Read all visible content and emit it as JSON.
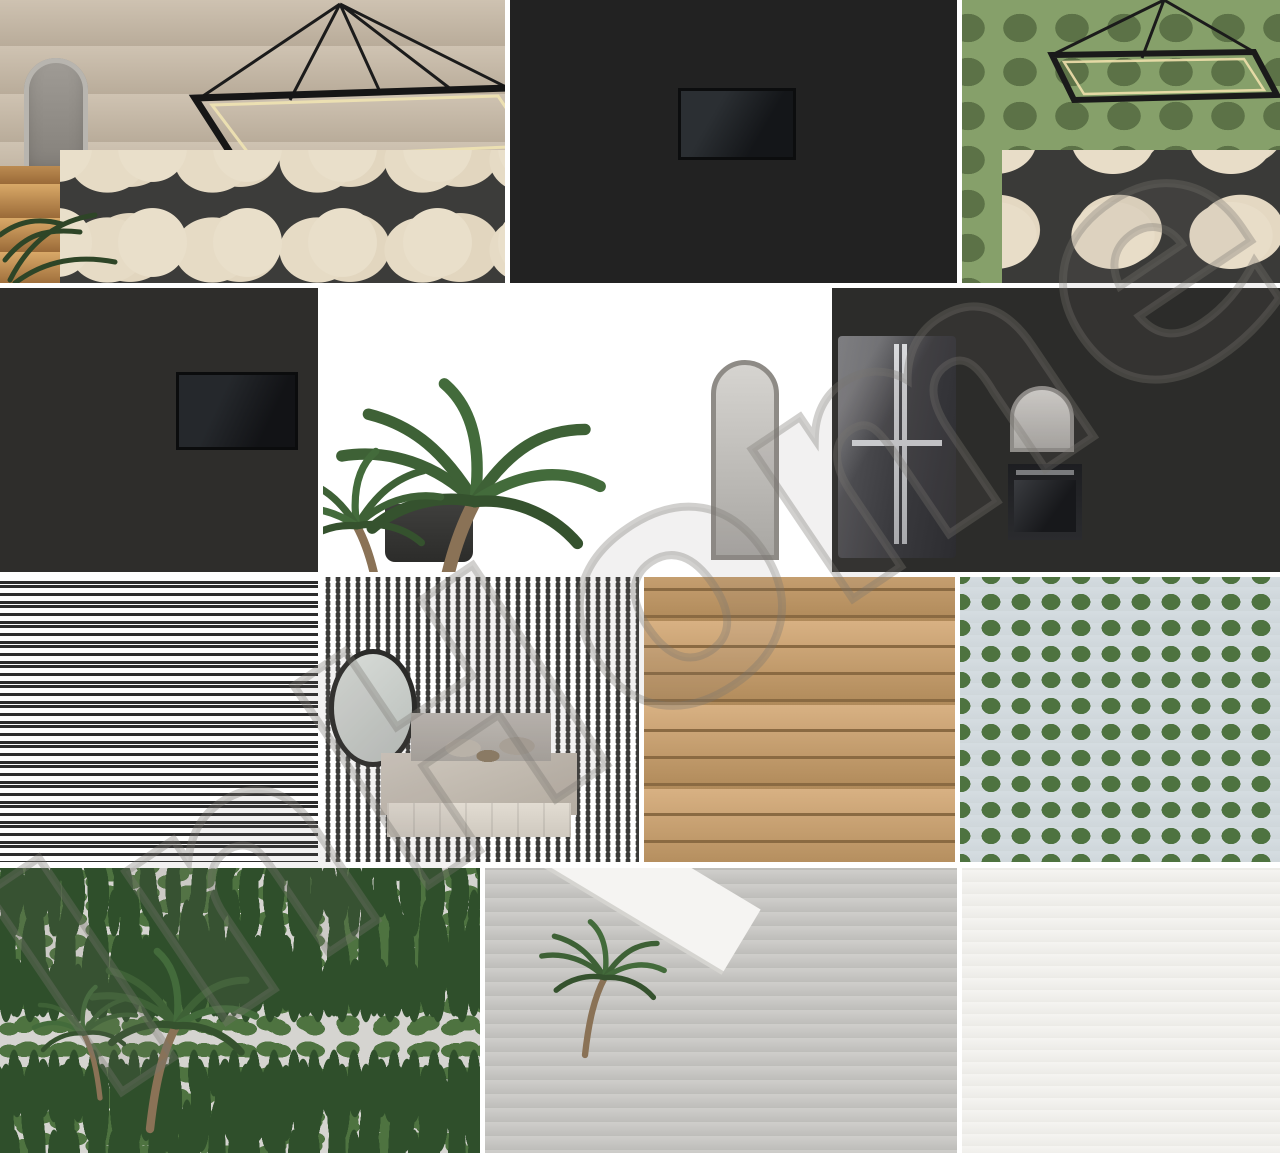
{
  "collage": {
    "watermark": {
      "text": "InHome",
      "style": "outline",
      "color": "#7d7a76",
      "rotation_deg": -34
    },
    "rows": 4,
    "tile_count": 13,
    "gap_color": "#ffffff",
    "tiles": [
      {
        "id": "living-dining-room",
        "row": 1,
        "label": "Open-plan living and dining room with rectangular LED chandelier, cream barrel chairs, marble table and sea-view glazing"
      },
      {
        "id": "living-room-tv",
        "row": 1,
        "label": "Living room with central white TV partition wall, grey corner sofa, round coffee table and wooden media console"
      },
      {
        "id": "dining-room-chandelier",
        "row": 1,
        "label": "Dining room with black rectangular LED chandelier, sheer window, olive curtains and cream chairs"
      },
      {
        "id": "living-room-media-wall",
        "row": 2,
        "label": "Living room with black TV on white media wall, kitchen island with lit niche, marble coffee tables and cream sofa"
      },
      {
        "id": "kitchen-palm",
        "row": 2,
        "label": "Beige handleless kitchen with tall palm plant, walnut wardrobe panel and grey marble island with warm lit shelf"
      },
      {
        "id": "kitchen-fridge",
        "row": 2,
        "label": "Kitchen with smoked-glass four-door fridge, black chimney hood, built-in oven and open sea-view lounge"
      },
      {
        "id": "bathroom-vanity",
        "row": 3,
        "label": "Bathroom with backlit mirror cabinet, amber-lit shelving, vessel sink vanity and glass walk-in shower"
      },
      {
        "id": "bedroom",
        "row": 3,
        "label": "Bedroom with upholstered bed, taupe bedding, round black mirror, warm-lit wardrobe shelving and textured rug"
      },
      {
        "id": "bathroom-wc",
        "row": 3,
        "label": "Marble guest bathroom with white door, wall-hung WC, glass screen, floating vanity and towel shelves"
      },
      {
        "id": "pool-terrace",
        "row": 3,
        "label": "Pool terrace with white sun loungers, timber slat fence, white facade with balcony and deep blue pool"
      },
      {
        "id": "garden-pool",
        "row": 4,
        "label": "Garden pool with palm and cypress trees, timber deck, four white loungers and turquoise water"
      },
      {
        "id": "villa-terrace",
        "row": 4,
        "label": "Modern villa terrace with white canopies, dark timber tower, steps to spa, outdoor lounge set and glass railing"
      },
      {
        "id": "apartment-building",
        "row": 4,
        "label": "Four-storey white apartment building with central stone core, planted balconies, roof terrace and cypress trees"
      }
    ],
    "palette": {
      "gap": "#ffffff",
      "marble": "#e9e5dd",
      "wood": "#8a6a48",
      "dark_wood": "#3f2e22",
      "sky": "#5b82bb",
      "pool": "#2e7d9e",
      "greenery": "#3e6136",
      "charcoal": "#232527",
      "cream": "#e3d9c6"
    }
  }
}
